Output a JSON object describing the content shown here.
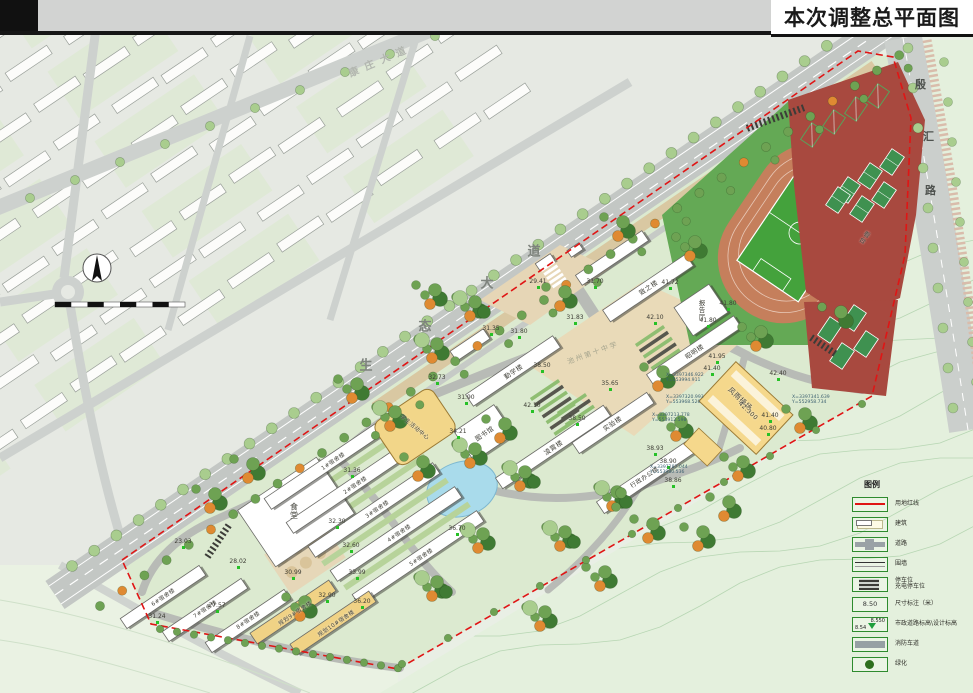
{
  "header": {
    "title": "本次调整总平面图"
  },
  "roads": {
    "avenue": {
      "name": "生态大道",
      "chars": [
        {
          "c": "生",
          "x": 366,
          "y": 364
        },
        {
          "c": "态",
          "x": 425,
          "y": 325
        },
        {
          "c": "大",
          "x": 487,
          "y": 282
        },
        {
          "c": "道",
          "x": 534,
          "y": 250
        }
      ]
    },
    "upper": {
      "name": "康庄大道",
      "x": 346,
      "y": 52,
      "rot": -23
    },
    "right": {
      "name": "殷汇路",
      "chars": [
        {
          "c": "殷",
          "x": 915,
          "y": 76
        },
        {
          "c": "汇",
          "x": 923,
          "y": 128
        },
        {
          "c": "路",
          "x": 925,
          "y": 182
        }
      ]
    }
  },
  "watermark": {
    "text": "池州第十中学",
    "x": 566,
    "y": 348
  },
  "buildings": [
    {
      "name": "致之楼",
      "x": 648,
      "y": 287,
      "rot": -34
    },
    {
      "name": "报告厅",
      "x": 701,
      "y": 310,
      "vert": true
    },
    {
      "name": "昭明楼",
      "x": 694,
      "y": 351,
      "rot": -34
    },
    {
      "name": "勤学楼",
      "x": 513,
      "y": 371,
      "rot": -34
    },
    {
      "name": "图书馆",
      "x": 484,
      "y": 433,
      "rot": -34
    },
    {
      "name": "凌霄楼",
      "x": 553,
      "y": 447,
      "rot": -34
    },
    {
      "name": "实验楼",
      "x": 612,
      "y": 423,
      "rot": -34
    },
    {
      "name": "行政办公楼",
      "x": 644,
      "y": 477,
      "rot": -34,
      "fs": 6
    },
    {
      "name": "风雨操场",
      "x": 740,
      "y": 399,
      "rot": 43,
      "fs": 7
    },
    {
      "name": "42.300",
      "x": 748,
      "y": 411,
      "rot": 43,
      "fs": 6
    },
    {
      "name": "看台",
      "x": 864,
      "y": 237,
      "rot": 34,
      "vert": true
    },
    {
      "name": "食堂",
      "x": 294,
      "y": 511,
      "vert": true,
      "fs": 8
    },
    {
      "name": "学生活动中心",
      "x": 415,
      "y": 427,
      "rot": 40,
      "fs": 5.5
    },
    {
      "name": "1#宿舍楼",
      "x": 333,
      "y": 461,
      "rot": -34,
      "fs": 5.5
    },
    {
      "name": "2#宿舍楼",
      "x": 355,
      "y": 485,
      "rot": -34,
      "fs": 5.5
    },
    {
      "name": "3#宿舍楼",
      "x": 377,
      "y": 509,
      "rot": -34,
      "fs": 5.5
    },
    {
      "name": "4#宿舍楼",
      "x": 399,
      "y": 533,
      "rot": -34,
      "fs": 5.5
    },
    {
      "name": "5#宿舍楼",
      "x": 421,
      "y": 557,
      "rot": -34,
      "fs": 5.5
    },
    {
      "name": "6#宿舍楼",
      "x": 163,
      "y": 597,
      "rot": -34,
      "fs": 5.5
    },
    {
      "name": "7#宿舍楼",
      "x": 205,
      "y": 609,
      "rot": -34,
      "fs": 5.5
    },
    {
      "name": "8#宿舍楼",
      "x": 248,
      "y": 620,
      "rot": -34,
      "fs": 5.5
    },
    {
      "name": "规划9#宿舍楼",
      "x": 295,
      "y": 613,
      "rot": -34,
      "fs": 5.5
    },
    {
      "name": "规划10#宿舍楼",
      "x": 336,
      "y": 623,
      "rot": -34,
      "fs": 5.5
    }
  ],
  "spots": [
    {
      "x": 538,
      "y": 283,
      "v": "29.41"
    },
    {
      "x": 595,
      "y": 283,
      "v": "31.70"
    },
    {
      "x": 575,
      "y": 319,
      "v": "31.83"
    },
    {
      "x": 491,
      "y": 330,
      "v": "31.35"
    },
    {
      "x": 519,
      "y": 333,
      "v": "31.80"
    },
    {
      "x": 437,
      "y": 379,
      "v": "32.73"
    },
    {
      "x": 466,
      "y": 399,
      "v": "31.90"
    },
    {
      "x": 352,
      "y": 472,
      "v": "31.36"
    },
    {
      "x": 337,
      "y": 523,
      "v": "32.30"
    },
    {
      "x": 351,
      "y": 547,
      "v": "32.60"
    },
    {
      "x": 183,
      "y": 543,
      "v": "23.03"
    },
    {
      "x": 238,
      "y": 563,
      "v": "28.02"
    },
    {
      "x": 293,
      "y": 574,
      "v": "30.99"
    },
    {
      "x": 357,
      "y": 574,
      "v": "33.99"
    },
    {
      "x": 327,
      "y": 597,
      "v": "32.90"
    },
    {
      "x": 362,
      "y": 603,
      "v": "36.20"
    },
    {
      "x": 157,
      "y": 618,
      "v": "31.24"
    },
    {
      "x": 217,
      "y": 607,
      "v": "27.57"
    },
    {
      "x": 542,
      "y": 367,
      "v": "38.50"
    },
    {
      "x": 610,
      "y": 385,
      "v": "35.65"
    },
    {
      "x": 577,
      "y": 420,
      "v": "38.50"
    },
    {
      "x": 655,
      "y": 319,
      "v": "42.10"
    },
    {
      "x": 532,
      "y": 407,
      "v": "42.10"
    },
    {
      "x": 670,
      "y": 284,
      "v": "41.72"
    },
    {
      "x": 728,
      "y": 305,
      "v": "41.80"
    },
    {
      "x": 708,
      "y": 322,
      "v": "41.80"
    },
    {
      "x": 717,
      "y": 358,
      "v": "41.95"
    },
    {
      "x": 712,
      "y": 370,
      "v": "41.40"
    },
    {
      "x": 778,
      "y": 375,
      "v": "42.40"
    },
    {
      "x": 770,
      "y": 417,
      "v": "41.40"
    },
    {
      "x": 768,
      "y": 430,
      "v": "40.80"
    },
    {
      "x": 668,
      "y": 463,
      "v": "38.90"
    },
    {
      "x": 673,
      "y": 482,
      "v": "38.86"
    },
    {
      "x": 655,
      "y": 450,
      "v": "38.93"
    },
    {
      "x": 457,
      "y": 530,
      "v": "36.70"
    },
    {
      "x": 458,
      "y": 433,
      "v": "34.21"
    }
  ],
  "coords": [
    {
      "x": 666,
      "y": 373,
      "l1": "X=3397346.922",
      "l2": "Y=553994.911"
    },
    {
      "x": 666,
      "y": 395,
      "l1": "X=3397320.993",
      "l2": "Y=553968.526"
    },
    {
      "x": 652,
      "y": 413,
      "l1": "X=3397213.778",
      "l2": "Y=553912.598"
    },
    {
      "x": 650,
      "y": 465,
      "l1": "X=3397287.044",
      "l2": "Y=553980.536"
    },
    {
      "x": 792,
      "y": 395,
      "l1": "X=3397341.639",
      "l2": "Y=552958.734"
    }
  ],
  "legend": {
    "title": "图例",
    "items": [
      {
        "type": "redline",
        "label": "用地红线"
      },
      {
        "type": "building",
        "label": "建筑"
      },
      {
        "type": "road",
        "label": "道路"
      },
      {
        "type": "wall",
        "label": "围墙"
      },
      {
        "type": "parking",
        "label": "停车位",
        "label2": "充电停车位"
      },
      {
        "type": "dim",
        "label": "尺寸标注（米）",
        "value": "8.50"
      },
      {
        "type": "elev",
        "label": "市政道路标高\\设计标高",
        "v1": "8.550",
        "v2": "8.54"
      },
      {
        "type": "fire",
        "label": "消防车道"
      },
      {
        "type": "green",
        "label": "绿化"
      }
    ]
  },
  "colors": {
    "boundary": "#e01515",
    "track": "#c57f5c",
    "field": "#44a23c",
    "court_bg": "#a8493f",
    "court": "#3f9150",
    "building_yellow": "#f2d689",
    "pond": "#a9dbeb"
  }
}
